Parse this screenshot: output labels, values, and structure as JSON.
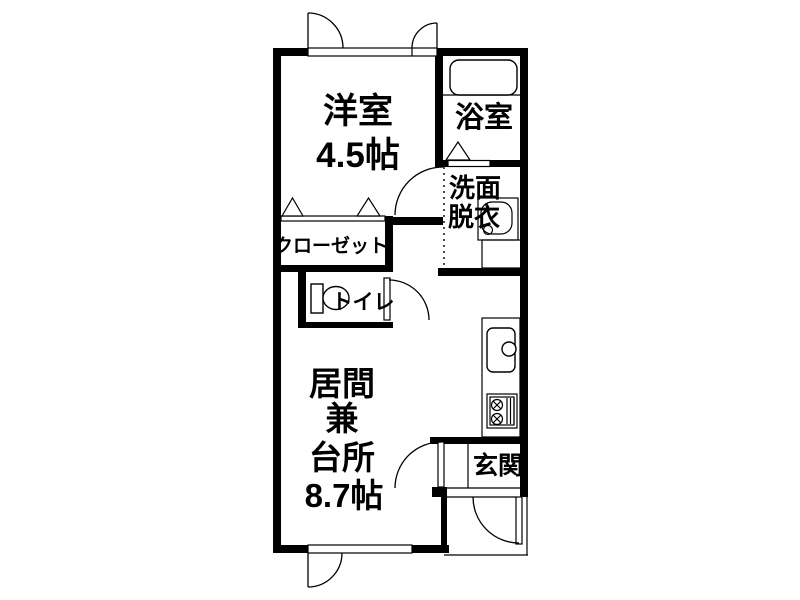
{
  "floor_plan": {
    "western_room": {
      "label": "洋室",
      "size": "4.5帖"
    },
    "bathroom": {
      "label": "浴室"
    },
    "washroom": {
      "label_line1": "洗面",
      "label_line2": "脱衣"
    },
    "closet": {
      "label": "クローゼット"
    },
    "toilet": {
      "label": "トイレ"
    },
    "living_kitchen": {
      "label_line1": "居間",
      "label_line2": "兼",
      "label_line3": "台所",
      "size": "8.7帖"
    },
    "entrance": {
      "label": "玄関"
    }
  },
  "colors": {
    "walls": "#000000",
    "background": "#ffffff"
  }
}
